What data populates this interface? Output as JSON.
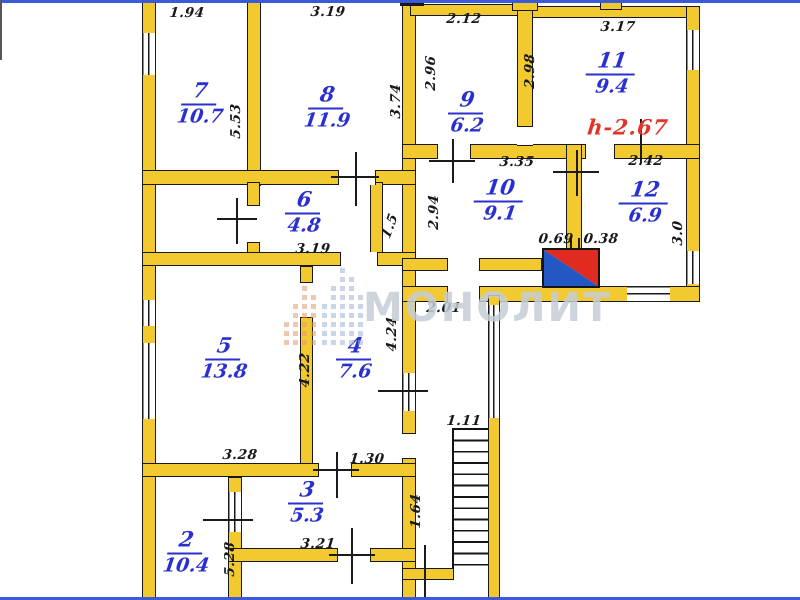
{
  "plan_title": "apartment floor plan",
  "watermark": {
    "text": "МОНОЛИТ"
  },
  "height_note": {
    "text": "h-2.67",
    "x": 628,
    "y": 127
  },
  "colors": {
    "wall_fill": "#f2ca30",
    "room_label": "#2a30cf",
    "dimension_text": "#17181c",
    "height_note": "#e0352a",
    "stove_red": "#e02c20",
    "stove_blue": "#2257c4",
    "scan_border_blue": "#3b5bd6"
  },
  "rooms": [
    {
      "number": "7",
      "area": "10.7",
      "x": 200,
      "y": 103
    },
    {
      "number": "8",
      "area": "11.9",
      "x": 327,
      "y": 107
    },
    {
      "number": "9",
      "area": "6.2",
      "x": 467,
      "y": 112
    },
    {
      "number": "11",
      "area": "9.4",
      "x": 612,
      "y": 73
    },
    {
      "number": "10",
      "area": "9.1",
      "x": 500,
      "y": 200
    },
    {
      "number": "12",
      "area": "6.9",
      "x": 645,
      "y": 202
    },
    {
      "number": "6",
      "area": "4.8",
      "x": 304,
      "y": 212
    },
    {
      "number": "5",
      "area": "13.8",
      "x": 224,
      "y": 358
    },
    {
      "number": "4",
      "area": "7.6",
      "x": 355,
      "y": 358
    },
    {
      "number": "3",
      "area": "5.3",
      "x": 307,
      "y": 502
    },
    {
      "number": "2",
      "area": "10.4",
      "x": 186,
      "y": 552
    }
  ],
  "dimensions": [
    {
      "text": "1.94",
      "x": 187,
      "y": 13,
      "rot": 0
    },
    {
      "text": "3.19",
      "x": 328,
      "y": 12,
      "rot": 0
    },
    {
      "text": "2.12",
      "x": 464,
      "y": 19,
      "rot": 0
    },
    {
      "text": "3.17",
      "x": 618,
      "y": 27,
      "rot": 0
    },
    {
      "text": "2.96",
      "x": 431,
      "y": 73,
      "rot": -90
    },
    {
      "text": "2.98",
      "x": 530,
      "y": 71,
      "rot": -90
    },
    {
      "text": "5.53",
      "x": 236,
      "y": 121,
      "rot": -90
    },
    {
      "text": "3.74",
      "x": 396,
      "y": 101,
      "rot": -90
    },
    {
      "text": "3.35",
      "x": 517,
      "y": 162,
      "rot": 0
    },
    {
      "text": "2.42",
      "x": 646,
      "y": 161,
      "rot": 0
    },
    {
      "text": "2.94",
      "x": 434,
      "y": 212,
      "rot": -90
    },
    {
      "text": "3.0",
      "x": 678,
      "y": 233,
      "rot": -90
    },
    {
      "text": "0.69",
      "x": 556,
      "y": 239,
      "rot": 0
    },
    {
      "text": "0.38",
      "x": 601,
      "y": 239,
      "rot": 0
    },
    {
      "text": "3.19",
      "x": 313,
      "y": 249,
      "rot": 0
    },
    {
      "text": "1.5",
      "x": 390,
      "y": 226,
      "rot": -70
    },
    {
      "text": "2.01",
      "x": 444,
      "y": 308,
      "rot": 0
    },
    {
      "text": "4.22",
      "x": 305,
      "y": 370,
      "rot": -90
    },
    {
      "text": "4.24",
      "x": 392,
      "y": 334,
      "rot": -90
    },
    {
      "text": "3.28",
      "x": 240,
      "y": 455,
      "rot": 0
    },
    {
      "text": "1.30",
      "x": 367,
      "y": 459,
      "rot": 0
    },
    {
      "text": "1.11",
      "x": 464,
      "y": 421,
      "rot": 0
    },
    {
      "text": "3.21",
      "x": 318,
      "y": 544,
      "rot": 0
    },
    {
      "text": "1.64",
      "x": 416,
      "y": 511,
      "rot": -90
    },
    {
      "text": "5.28",
      "x": 230,
      "y": 559,
      "rot": -90
    }
  ]
}
